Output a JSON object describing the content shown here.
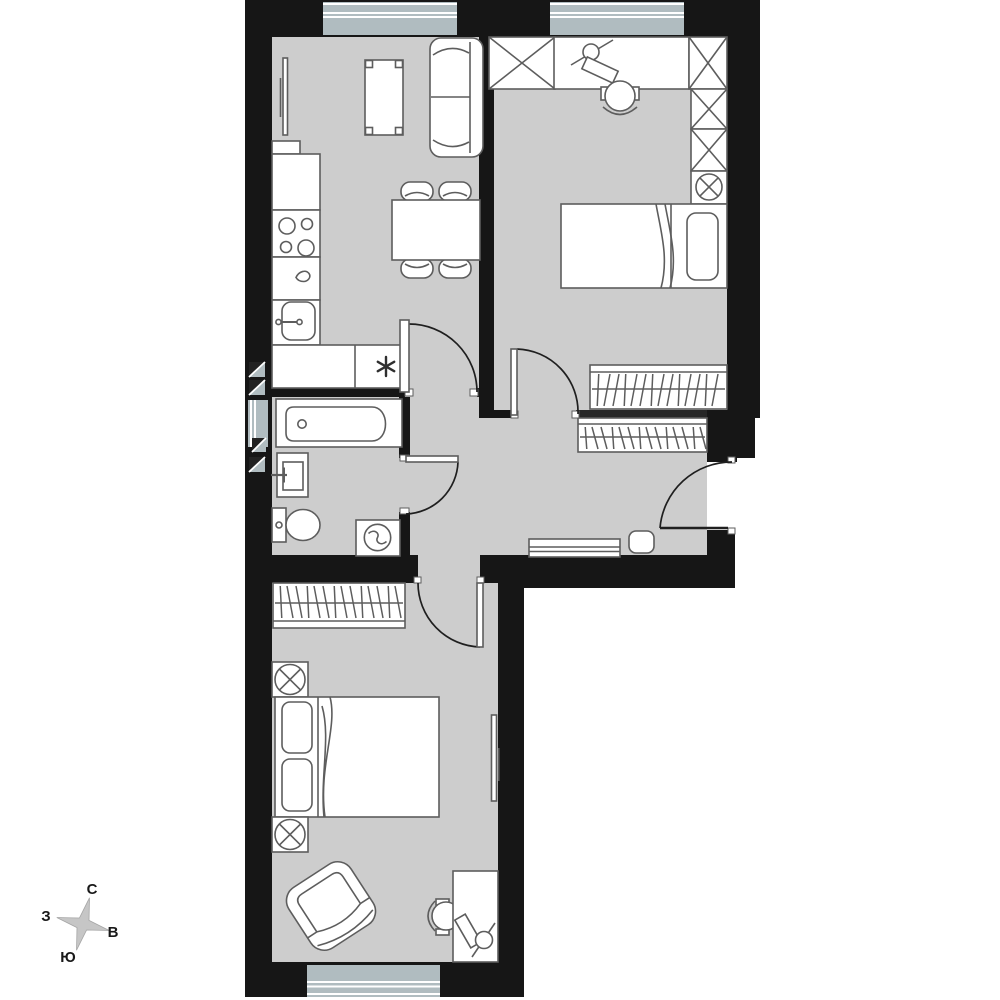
{
  "compass": {
    "north_label": "С",
    "east_label": "В",
    "south_label": "Ю",
    "west_label": "З"
  },
  "palette": {
    "background": "#ffffff",
    "floor": "#cdcdcd",
    "wall": "#161616",
    "line": "#5d5d5d",
    "glass": "#b0bcc0",
    "star": "#c6c6c6"
  },
  "rooms": [
    {
      "id": "kitchen-living-room",
      "fixtures": [
        "fridge",
        "stove-4-burners",
        "countertop",
        "kitchen-sink",
        "asterisk-appliance",
        "wall-tv",
        "coffee-table",
        "sofa",
        "dining-table",
        "dining-chairs",
        "window"
      ]
    },
    {
      "id": "bedroom-top",
      "fixtures": [
        "closet-x",
        "desk",
        "desk-lamp",
        "keyboard",
        "office-chair",
        "lamp-table",
        "single-bed",
        "wardrobe-hangers",
        "window",
        "door"
      ]
    },
    {
      "id": "hallway",
      "fixtures": [
        "wardrobe-hangers",
        "pouf",
        "shoe-cabinet",
        "entrance-door"
      ]
    },
    {
      "id": "bathroom",
      "fixtures": [
        "bathtub",
        "washbasin",
        "toilet",
        "washing-machine",
        "vent-shafts",
        "window-slot",
        "door"
      ]
    },
    {
      "id": "bedroom-bottom",
      "fixtures": [
        "wardrobe-hangers",
        "double-bed",
        "nightstand-lamps",
        "wall-tv",
        "armchair",
        "desk",
        "desk-lamp",
        "keyboard",
        "office-chair",
        "window",
        "door"
      ]
    }
  ]
}
